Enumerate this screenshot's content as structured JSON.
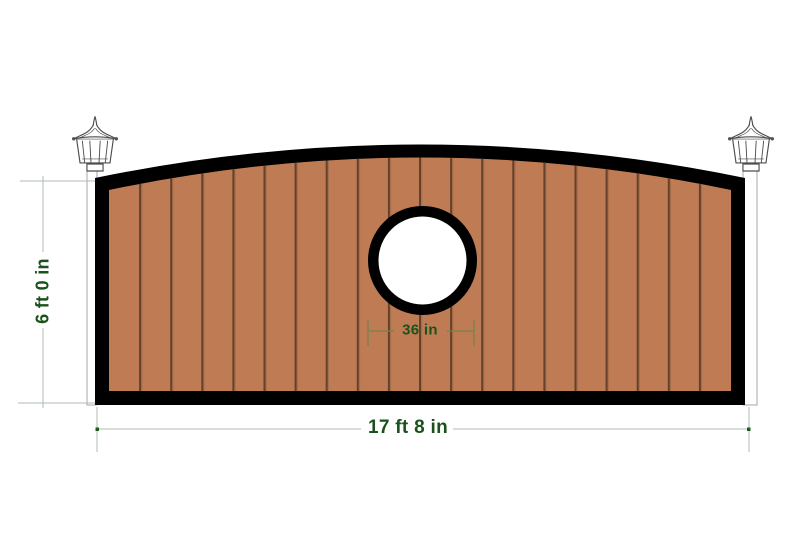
{
  "design_preview": {
    "dimensions": {
      "height_label": "6 ft 0 in",
      "width_label": "17 ft 8 in",
      "medallion_diameter_label": "36 in"
    },
    "gate": {
      "plank_count": 20,
      "frame_color": "#000000",
      "wood_color": "#BF7C54",
      "groove_color": "#63412C",
      "groove_highlight_color": "#A96F49",
      "medallion": {
        "ring_color": "#000000",
        "face_color": "#FFFFFF",
        "artwork": "rose-line-art"
      }
    },
    "posts": {
      "fill_color": "#FFFFFF",
      "outline_color": "#A7A7A7"
    },
    "annotations": {
      "dimension_text_color": "#1B521B",
      "dimension_line_color": "#AFBCAF",
      "medallion_dimension_line_color": "#75814F",
      "dimension_dot_color": "#1E5A1E"
    },
    "background_color": "#FFFFFF",
    "icons": {
      "left_lamp": "lantern-lamp-icon",
      "right_lamp": "lantern-lamp-icon"
    }
  }
}
